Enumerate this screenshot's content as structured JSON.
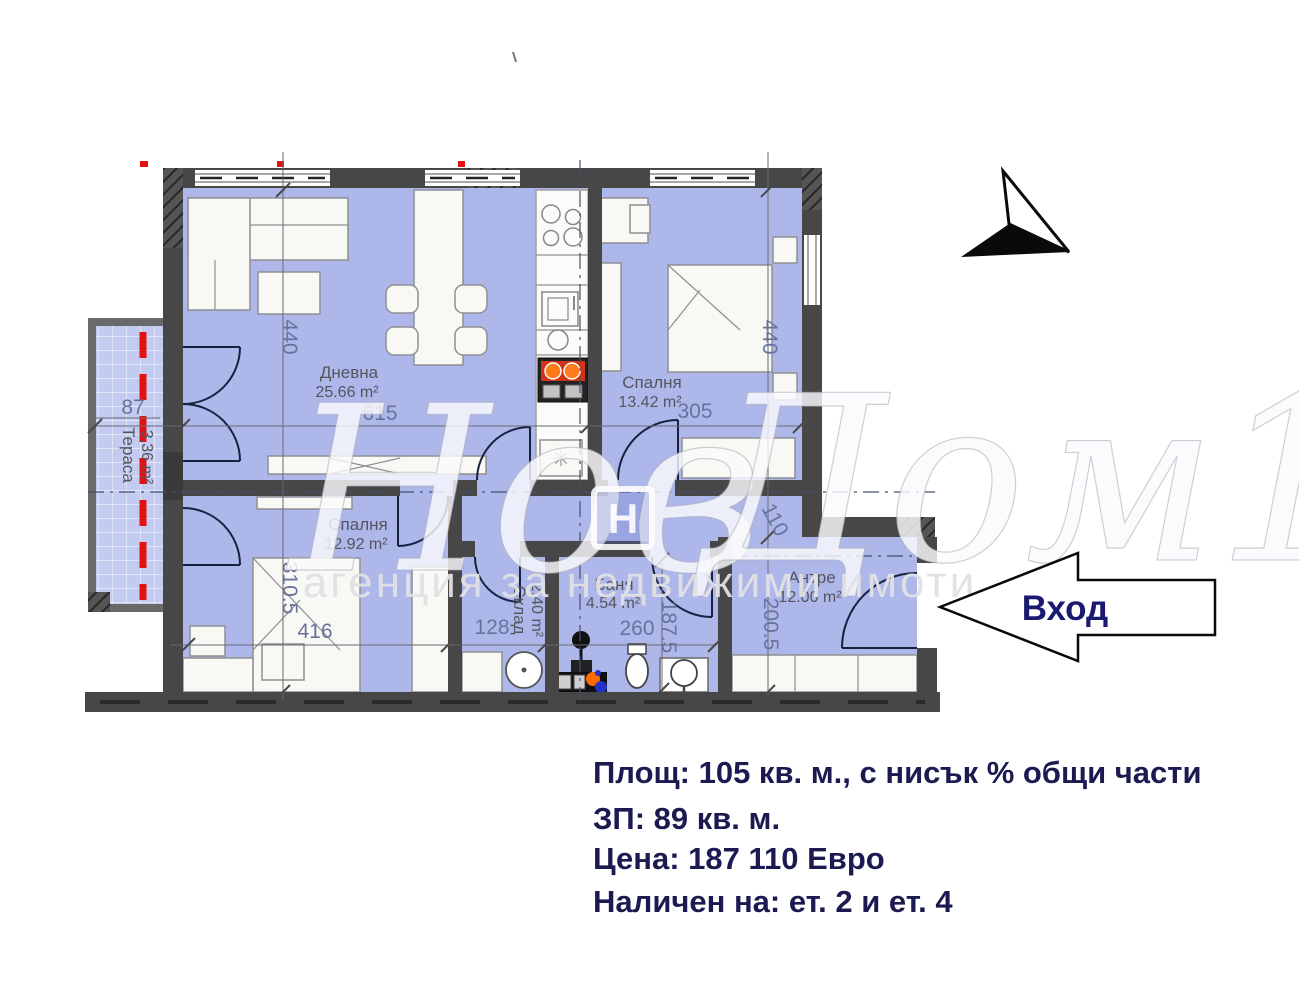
{
  "plan": {
    "rooms": [
      {
        "id": "living",
        "label": "Дневна",
        "area": "25.66 m²",
        "dim_w": "615",
        "dim_h": "440"
      },
      {
        "id": "bedroom-top",
        "label": "Спалня",
        "area": "13.42 m²",
        "dim_w": "305",
        "dim_h": "440"
      },
      {
        "id": "bedroom-bottom",
        "label": "Спалня",
        "area": "12.92 m²",
        "dim_w": "416",
        "dim_h": "310.5"
      },
      {
        "id": "storage",
        "label": "Склад",
        "area": "2.40 m²",
        "dim_w": "128"
      },
      {
        "id": "bathroom",
        "label": "Баня",
        "area": "4.54 m²",
        "dim_w": "260",
        "dim_h": "187.5"
      },
      {
        "id": "hallway",
        "label": "Антре",
        "area": "12.00 m²",
        "dim_w": "110",
        "dim_h": "200.5"
      },
      {
        "id": "terrace",
        "label": "Тераса",
        "area": "3.36 m²",
        "dim_w": "87"
      }
    ],
    "entrance": {
      "label": "Вход"
    }
  },
  "watermark": {
    "script_1": "Нов",
    "script_2": "Дом1",
    "logo_letter": "H",
    "tagline": "агенция за недвижими имоти"
  },
  "details": {
    "lines": [
      "Площ: 105 кв. м., с нисък % общи части",
      "ЗП: 89 кв. м.",
      "Цена: 187 110 Евро",
      "Наличен на: ет. 2 и ет. 4"
    ]
  },
  "colors": {
    "floor_fill": "#aeb7ea",
    "terrace_fill": "#c3cbf1",
    "wall": "#474747",
    "dim_text": "#66739c",
    "room_text": "#55555f",
    "info_text": "#1b1b52",
    "accent_red": "#e31212",
    "stove_orange": "#ff7a1a"
  }
}
